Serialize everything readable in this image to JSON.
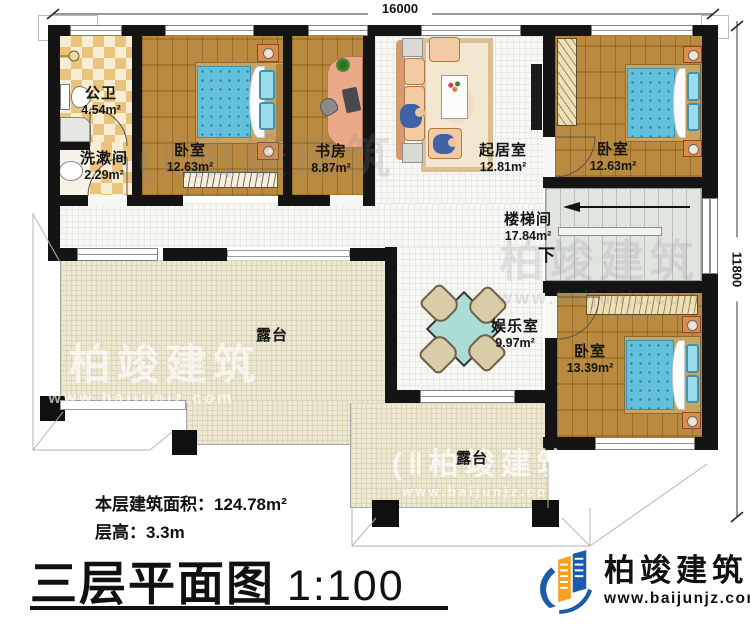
{
  "plan": {
    "dim_width": "16000",
    "dim_height": "11800",
    "rooms": [
      {
        "name": "公卫",
        "area": "4.54m²"
      },
      {
        "name": "洗漱间",
        "area": "2.29m²"
      },
      {
        "name": "卧室",
        "area": "12.63m²"
      },
      {
        "name": "书房",
        "area": "8.87m²"
      },
      {
        "name": "起居室",
        "area": "12.81m²"
      },
      {
        "name": "卧室",
        "area": "12.63m²"
      },
      {
        "name": "楼梯间",
        "area": "17.84m²"
      },
      {
        "name": "娱乐室",
        "area": "9.97m²"
      },
      {
        "name": "卧室",
        "area": "13.39m²"
      },
      {
        "name": "露台"
      },
      {
        "name": "露台"
      }
    ],
    "stair_down": "下"
  },
  "footer": {
    "area_label": "本层建筑面积：",
    "area_value": "124.78m²",
    "height_label": "层高：",
    "height_value": "3.3m",
    "title": "三层平面图",
    "scale": "1:100"
  },
  "brand": {
    "name": "柏竣建筑",
    "url": "www.baijunjz.com"
  },
  "watermark": {
    "icon": "(‖",
    "text": "柏竣建筑",
    "url": "www.baijunjz.com"
  },
  "colors": {
    "wall": "#141414",
    "wood": "#af7d2e",
    "bed_blue": "#63c0dc",
    "checker_tan": "#e8c47c",
    "terrace_beige": "#ede8d3",
    "stair_gray": "#e1e5e0",
    "logo_blue": "#1c5ba9",
    "logo_orange": "#f5a01e"
  }
}
